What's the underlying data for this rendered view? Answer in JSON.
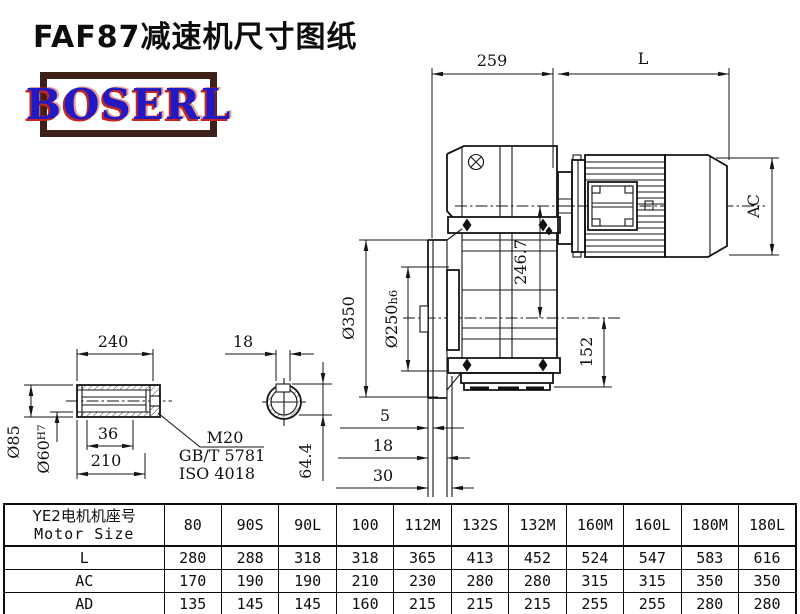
{
  "title": "FAF87减速机尺寸图纸",
  "logo": {
    "text": "BOSERL",
    "text_color": "#2319c4",
    "shadow_color": "#c3261a",
    "border_color": "#3d2018"
  },
  "drawing": {
    "line_color": "#151515",
    "main_view": {
      "dim_overall_width": "259",
      "dim_motor_length": "L",
      "dim_motor_diameter": "AC",
      "dim_flange_diameter": "Ø350",
      "dim_spigot_diameter": "Ø250",
      "dim_spigot_tolerance": "h6",
      "dim_axis_distance": "246.7",
      "dim_foot_height": "152",
      "dim_flange_step_1": "5",
      "dim_flange_step_2": "18",
      "dim_flange_step_3": "30"
    },
    "shaft_view": {
      "dim_length": "240",
      "dim_step": "36",
      "dim_hub_length": "210",
      "dim_outer_diameter": "Ø85",
      "dim_bore_diameter": "Ø60",
      "dim_bore_tolerance": "H7",
      "note_thread": "M20",
      "note_standard_gb": "GB/T 5781",
      "note_standard_iso": "ISO 4018"
    },
    "section_view": {
      "dim_keyway_width": "18",
      "dim_keyway_depth": "64.4"
    }
  },
  "table": {
    "header_cn": "YE2电机机座号",
    "header_en": "Motor Size",
    "columns": [
      "80",
      "90S",
      "90L",
      "100",
      "112M",
      "132S",
      "132M",
      "160M",
      "160L",
      "180M",
      "180L"
    ],
    "rows": [
      {
        "label": "L",
        "values": [
          "280",
          "288",
          "318",
          "318",
          "365",
          "413",
          "452",
          "524",
          "547",
          "583",
          "616"
        ]
      },
      {
        "label": "AC",
        "values": [
          "170",
          "190",
          "190",
          "210",
          "230",
          "280",
          "280",
          "315",
          "315",
          "350",
          "350"
        ]
      },
      {
        "label": "AD",
        "values": [
          "135",
          "145",
          "145",
          "160",
          "215",
          "215",
          "215",
          "255",
          "255",
          "280",
          "280"
        ]
      }
    ]
  }
}
